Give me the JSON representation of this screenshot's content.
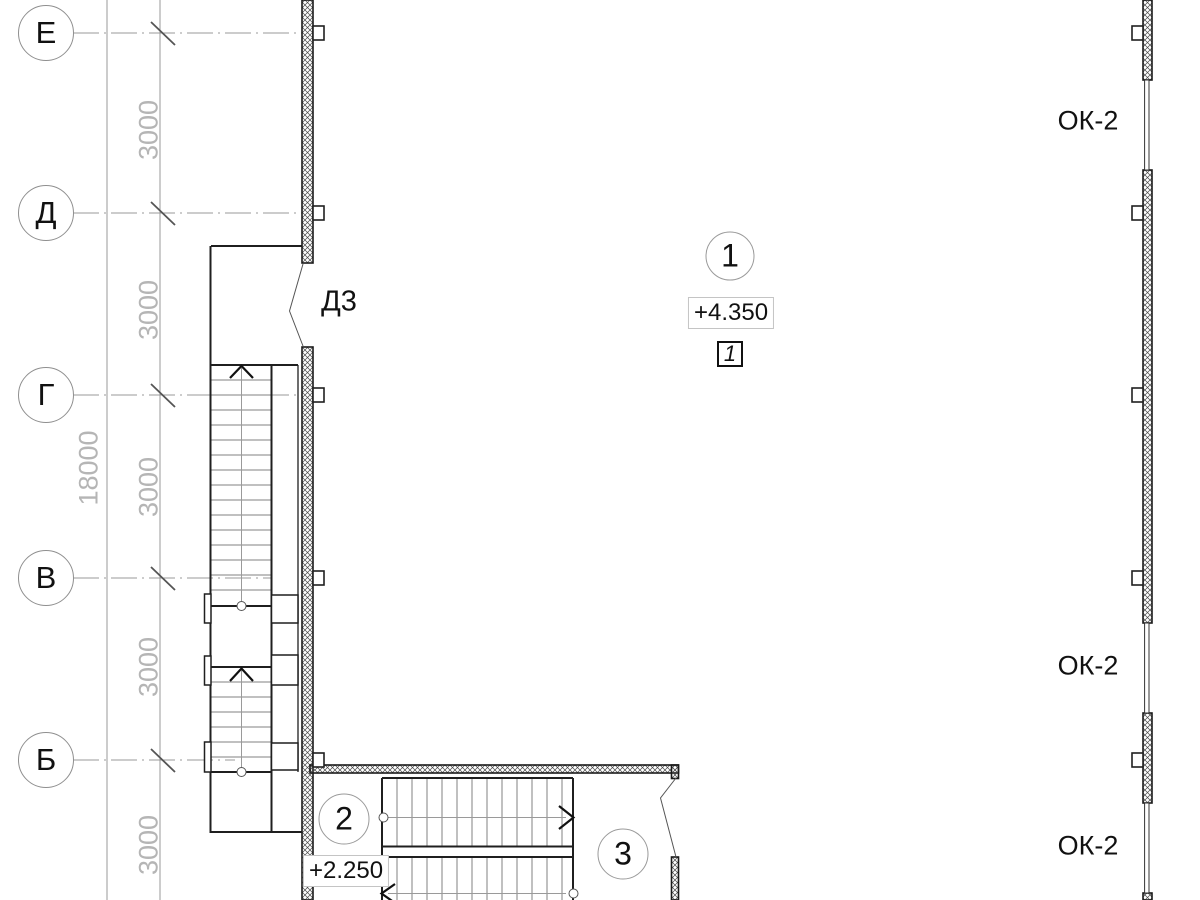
{
  "grid": {
    "bubbles": [
      {
        "label": "Е",
        "y": 33
      },
      {
        "label": "Д",
        "y": 213
      },
      {
        "label": "Г",
        "y": 395
      },
      {
        "label": "В",
        "y": 578
      },
      {
        "label": "Б",
        "y": 760
      }
    ],
    "segment_dims": [
      {
        "text": "3000",
        "y": 130
      },
      {
        "text": "3000",
        "y": 310
      },
      {
        "text": "3000",
        "y": 487
      },
      {
        "text": "3000",
        "y": 667
      },
      {
        "text": "3000",
        "y": 845
      }
    ],
    "total_dim": {
      "text": "18000",
      "y": 468
    }
  },
  "annotations": {
    "door_label": "Д3",
    "window_labels": [
      {
        "text": "ОК-2",
        "y": 121
      },
      {
        "text": "ОК-2",
        "y": 666
      },
      {
        "text": "ОК-2",
        "y": 846
      }
    ],
    "room_numbers": [
      {
        "text": "1",
        "x": 730,
        "y": 256
      },
      {
        "text": "2",
        "x": 344,
        "y": 819
      },
      {
        "text": "3",
        "x": 623,
        "y": 854
      }
    ],
    "levels": [
      {
        "text": "+4.350",
        "x": 731,
        "y": 313
      },
      {
        "text": "+2.250",
        "x": 346,
        "y": 871
      }
    ],
    "detail_mark": {
      "text": "1",
      "x": 730,
      "y": 354
    }
  },
  "colors": {
    "line_gray": "#999999",
    "dim_text": "#b5b5b5",
    "tick": "#555555",
    "heavy": "#1f1f1f",
    "wall_edge": "#1a1a1a",
    "hatch": "#4a4a4a",
    "tread": "#808080",
    "center": "#9a9a9a",
    "text": "#111111"
  },
  "drawing": {
    "grid_lines": [
      {
        "x1": 73,
        "y": 33,
        "x2": 302
      },
      {
        "x1": 73,
        "y": 213,
        "x2": 302
      },
      {
        "x1": 73,
        "y": 395,
        "x2": 302
      },
      {
        "x1": 73,
        "y": 578,
        "x2": 271
      },
      {
        "x1": 73,
        "y": 760,
        "x2": 235
      }
    ],
    "dim_lines": [
      {
        "x": 107,
        "y1": 0,
        "y2": 900
      },
      {
        "x": 160,
        "y1": 0,
        "y2": 900
      }
    ],
    "ticks": [
      33,
      213,
      395,
      578,
      760
    ],
    "hatch_walls": [
      {
        "x": 302,
        "y": 0,
        "w": 11,
        "h": 263,
        "name": "left-wall-upper"
      },
      {
        "x": 302,
        "y": 347,
        "w": 11,
        "h": 553,
        "name": "left-wall-lower"
      },
      {
        "x": 1143,
        "y": 0,
        "w": 9,
        "h": 80,
        "name": "right-wall-seg1"
      },
      {
        "x": 1143,
        "y": 170,
        "w": 9,
        "h": 453,
        "name": "right-wall-seg2"
      },
      {
        "x": 1143,
        "y": 713,
        "w": 9,
        "h": 90,
        "name": "right-wall-seg3"
      },
      {
        "x": 1143,
        "y": 893,
        "w": 9,
        "h": 7,
        "name": "right-wall-seg4"
      },
      {
        "x": 310,
        "y": 765,
        "w": 368.5,
        "h": 8,
        "name": "bottom-wall"
      },
      {
        "x": 671.5,
        "y": 765,
        "w": 7,
        "h": 13.5,
        "name": "bottom-wall-hook"
      },
      {
        "x": 671.5,
        "y": 857,
        "w": 7,
        "h": 43,
        "name": "bottom-right-wall"
      }
    ],
    "tabs": [
      {
        "x": 313,
        "y": 26
      },
      {
        "x": 313,
        "y": 206
      },
      {
        "x": 313,
        "y": 388
      },
      {
        "x": 313,
        "y": 571
      },
      {
        "x": 313,
        "y": 753
      },
      {
        "x": 1132,
        "y": 26
      },
      {
        "x": 1132,
        "y": 206
      },
      {
        "x": 1132,
        "y": 388
      },
      {
        "x": 1132,
        "y": 571
      },
      {
        "x": 1132,
        "y": 753
      }
    ],
    "tab_size": {
      "w": 11,
      "h": 14
    },
    "glazing": [
      {
        "x": 1144.6,
        "y": 80,
        "w": 4.4,
        "h": 90
      },
      {
        "x": 1144.6,
        "y": 623,
        "w": 4.4,
        "h": 90
      },
      {
        "x": 1144.6,
        "y": 803,
        "w": 4.4,
        "h": 90
      }
    ],
    "outline_rects": [
      {
        "x": 271.5,
        "y": 595,
        "w": 26.5,
        "h": 28
      },
      {
        "x": 271.5,
        "y": 655,
        "w": 26.5,
        "h": 30
      },
      {
        "x": 271.5,
        "y": 743,
        "w": 26.5,
        "h": 27
      },
      {
        "x": 204.5,
        "y": 594,
        "w": 6.5,
        "h": 29
      },
      {
        "x": 204.5,
        "y": 656,
        "w": 6.5,
        "h": 29
      },
      {
        "x": 204.5,
        "y": 742,
        "w": 6.5,
        "h": 30
      }
    ],
    "heavy_lines": [
      {
        "x1": 211,
        "y1": 246,
        "x2": 302,
        "y2": 246
      },
      {
        "x1": 210.5,
        "y1": 246,
        "x2": 210.5,
        "y2": 832
      },
      {
        "x1": 209.5,
        "y1": 832,
        "x2": 302,
        "y2": 832
      },
      {
        "x1": 211,
        "y1": 365,
        "x2": 298,
        "y2": 365
      },
      {
        "x1": 211,
        "y1": 606,
        "x2": 271.5,
        "y2": 606
      },
      {
        "x1": 211,
        "y1": 667,
        "x2": 271.5,
        "y2": 667
      },
      {
        "x1": 211,
        "y1": 772,
        "x2": 271.5,
        "y2": 772
      },
      {
        "x1": 271.5,
        "y1": 365,
        "x2": 271.5,
        "y2": 832
      },
      {
        "x1": 382,
        "y1": 778,
        "x2": 573,
        "y2": 778
      },
      {
        "x1": 382,
        "y1": 778,
        "x2": 382,
        "y2": 900
      },
      {
        "x1": 573,
        "y1": 778,
        "x2": 573,
        "y2": 900
      },
      {
        "x1": 382,
        "y1": 846.5,
        "x2": 573,
        "y2": 846.5
      },
      {
        "x1": 382,
        "y1": 857,
        "x2": 573,
        "y2": 857
      }
    ],
    "medium_lines": [
      {
        "x1": 298,
        "y1": 365,
        "x2": 298,
        "y2": 772
      }
    ],
    "center_lines": [
      {
        "x1": 241.5,
        "y1": 368,
        "x2": 241.5,
        "y2": 601
      },
      {
        "x1": 241.5,
        "y1": 669,
        "x2": 241.5,
        "y2": 767
      },
      {
        "x1": 388,
        "y1": 817.5,
        "x2": 566,
        "y2": 817.5
      },
      {
        "x1": 388,
        "y1": 893.5,
        "x2": 566,
        "y2": 893.5
      }
    ],
    "tread_runs": [
      {
        "dir": "h",
        "a1": 211,
        "a2": 271.5,
        "start": 380,
        "step": 15,
        "count": 15
      },
      {
        "dir": "h",
        "a1": 211,
        "a2": 271.5,
        "start": 682,
        "step": 15,
        "count": 6
      },
      {
        "dir": "v",
        "a1": 778,
        "a2": 846,
        "start": 397,
        "step": 15,
        "count": 12
      },
      {
        "dir": "v",
        "a1": 858,
        "a2": 900,
        "start": 397,
        "step": 15,
        "count": 12
      }
    ],
    "arrows": [
      {
        "points": "230,378 241.5,366 253,378",
        "name": "stair-up-arrow-1"
      },
      {
        "points": "230,681 241.5,668.5 253,681",
        "name": "stair-up-arrow-2"
      },
      {
        "points": "559,806 573.5,817.5 559,829",
        "name": "stair-right-arrow"
      },
      {
        "points": "395,884 381.5,893.5 395,903",
        "name": "stair-left-arrow"
      }
    ],
    "door_leaves": [
      {
        "points": "303,264 289.5,311 303,346",
        "name": "door-d3-leaf"
      },
      {
        "points": "676,778 660.5,798 676,857",
        "name": "door-bottom-leaf"
      }
    ],
    "pivot_circles": [
      {
        "cx": 241.5,
        "cy": 606
      },
      {
        "cx": 241.5,
        "cy": 772
      },
      {
        "cx": 383.5,
        "cy": 817.5
      },
      {
        "cx": 573.5,
        "cy": 893.5
      }
    ]
  }
}
